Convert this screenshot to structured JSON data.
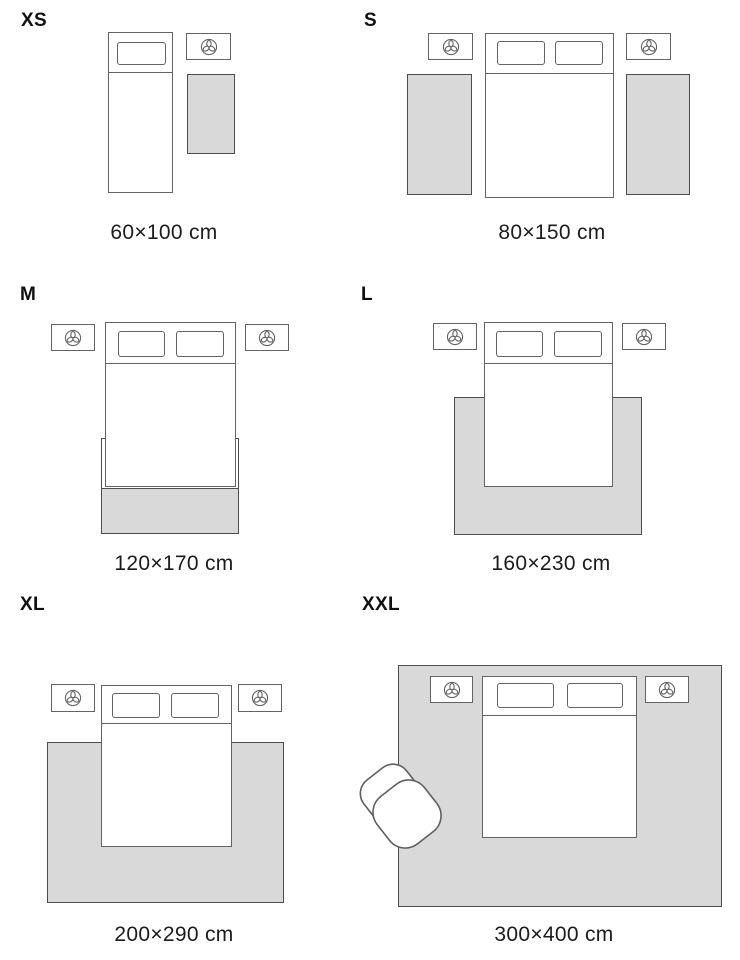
{
  "sizes": [
    {
      "id": "xs",
      "label": "XS",
      "dimensions": "60×100 cm"
    },
    {
      "id": "s",
      "label": "S",
      "dimensions": "80×150 cm"
    },
    {
      "id": "m",
      "label": "M",
      "dimensions": "120×170 cm"
    },
    {
      "id": "l",
      "label": "L",
      "dimensions": "160×230 cm"
    },
    {
      "id": "xl",
      "label": "XL",
      "dimensions": "200×290 cm"
    },
    {
      "id": "xxl",
      "label": "XXL",
      "dimensions": "300×400 cm"
    }
  ],
  "icons": {
    "nightstand": "plant-top-view-icon"
  },
  "colors": {
    "rug_fill": "#d9d9d9",
    "furniture_outline": "#636363",
    "rug_outline": "#4d4d4d",
    "text": "#1c1c1c"
  }
}
